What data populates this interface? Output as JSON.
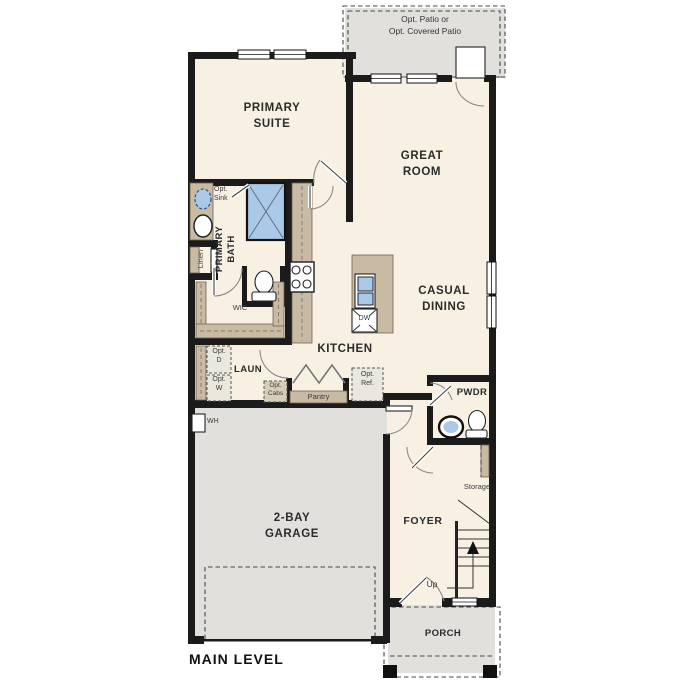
{
  "plan_title": "MAIN LEVEL",
  "colors": {
    "floor": "#f8f1e3",
    "exterior": "#e2e0dc",
    "cabinet": "#c9bba3",
    "fixture_blue": "#aac9e8",
    "wall": "#1b1b1b"
  },
  "labels": {
    "patio_line1": "Opt. Patio or",
    "patio_line2": "Opt. Covered Patio",
    "primary_suite_line1": "PRIMARY",
    "primary_suite_line2": "SUITE",
    "great_room_line1": "GREAT",
    "great_room_line2": "ROOM",
    "casual_dining_line1": "CASUAL",
    "casual_dining_line2": "DINING",
    "kitchen": "KITCHEN",
    "primary_bath_line1": "PRIMARY",
    "primary_bath_line2": "BATH",
    "opt_sink_line1": "Opt.",
    "opt_sink_line2": "Sink",
    "linen": "Linen",
    "wic": "WIC",
    "laundry": "LAUN",
    "opt_dryer_line1": "Opt.",
    "opt_dryer_line2": "D",
    "opt_washer_line1": "Opt.",
    "opt_washer_line2": "W",
    "opt_cabs_line1": "Opt.",
    "opt_cabs_line2": "Cabs",
    "pantry": "Pantry",
    "opt_ref_line1": "Opt.",
    "opt_ref_line2": "Ref.",
    "dishwasher": "DW",
    "water_heater": "WH",
    "pwdr": "PWDR",
    "storage": "Storage",
    "foyer": "FOYER",
    "up": "Up",
    "garage_line1": "2-BAY",
    "garage_line2": "GARAGE",
    "porch": "PORCH"
  }
}
